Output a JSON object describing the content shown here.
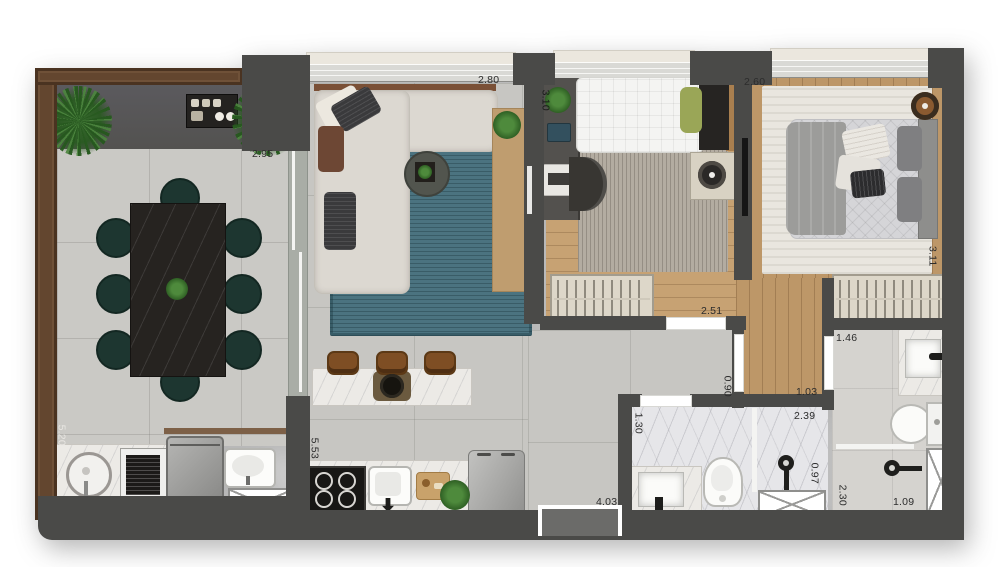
{
  "plan": {
    "title_note": "apartment floor plan, top-down render, no visible text other than dimension labels",
    "dims": {
      "terrace_opening": "2.95",
      "living_width": "2.80",
      "living_depth": "3.10",
      "bedroom2_width": "2.60",
      "bedroom2_depth": "3.11",
      "bedroom1_width": "2.51",
      "closet_hall": "1.46",
      "hall_door": "0.90",
      "hall_width": "1.03",
      "bathroom_width": "2.39",
      "bathroom_door": "1.30",
      "shower_width": "0.97",
      "ensuite_depth": "2.30",
      "ensuite_shower": "1.09",
      "kitchen_width": "4.03",
      "kitchen_depth": "5.53",
      "terrace_depth": "5.20"
    },
    "colors": {
      "background": "#ffffff",
      "wall": "#4a4a48",
      "terrace_frame": "#63462f",
      "concrete_floor": "#cac9c5",
      "gray_tile_floor": "#c7c6c2",
      "wood_floor": "#bd9768",
      "teal_rug": "#4b7380",
      "marble": "#eceae6",
      "sofa_cream": "#dcd8d1",
      "dining_table": "#262320",
      "dining_chair": "#1d3630",
      "plant_green": "#35682c",
      "window_band": "#d9d9d5"
    },
    "icons": [
      "potted-plant-icon",
      "bbq-grill-icon",
      "dining-table-icon",
      "dining-chair-icon",
      "outdoor-sink-icon",
      "washing-machine-icon",
      "laundry-tub-icon",
      "shaft-x-icon",
      "sliding-door-icon",
      "sofa-icon",
      "coffee-table-icon",
      "tv-console-icon",
      "kitchen-island-icon",
      "bar-stool-icon",
      "cooktop-icon",
      "kitchen-sink-icon",
      "cutting-board-icon",
      "refrigerator-icon",
      "single-bed-icon",
      "desk-icon",
      "desk-chair-icon",
      "nightstand-lamp-icon",
      "wardrobe-icon",
      "double-bed-icon",
      "side-table-icon",
      "vanity-sink-icon",
      "toilet-icon",
      "shower-head-icon",
      "shower-box-icon",
      "entrance-door-icon"
    ]
  }
}
